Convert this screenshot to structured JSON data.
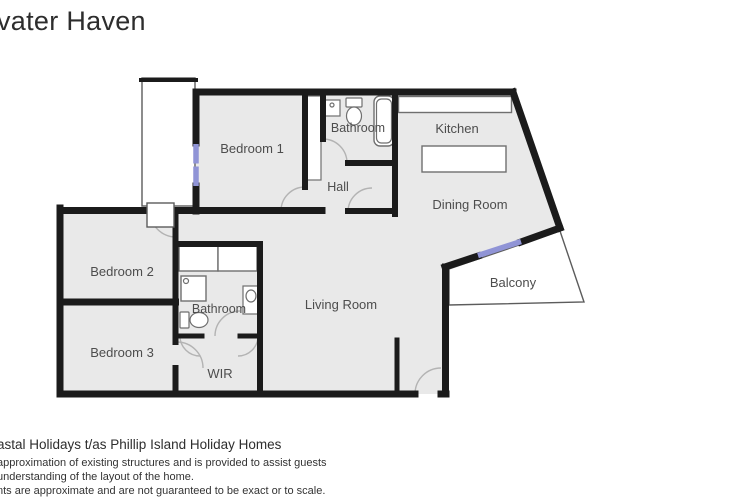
{
  "title": "vater Haven",
  "floorplan": {
    "rooms": [
      {
        "label": "Bedroom 1"
      },
      {
        "label": "Bathroom"
      },
      {
        "label": "Kitchen"
      },
      {
        "label": "Hall"
      },
      {
        "label": "Dining Room"
      },
      {
        "label": "Bedroom 2"
      },
      {
        "label": "Bathroom"
      },
      {
        "label": "Living Room"
      },
      {
        "label": "Balcony"
      },
      {
        "label": "Bedroom 3"
      },
      {
        "label": "WIR"
      }
    ],
    "fixtures": [
      "kitchen-counter",
      "kitchen-island",
      "bathtub",
      "toilet",
      "wall-cabinet",
      "built-in-robe",
      "robe",
      "robe",
      "shower",
      "vanity",
      "toilet",
      "porch",
      "entry-step",
      "balcony"
    ],
    "colors": {
      "wall": "#1b1b1b",
      "floor": "#e9e9e9",
      "window": "#9094d6",
      "fixture": "#6f6f6f",
      "arc": "#b3b3b3",
      "label": "#4d4d4d"
    }
  },
  "footer": {
    "line1": "astal Holidays t/as Phillip Island Holiday Homes",
    "line2": "approximation of existing structures and is provided to assist guests",
    "line3": "understanding of the layout of the home.",
    "line4": "nts are approximate and are not guaranteed to be exact or to scale."
  }
}
